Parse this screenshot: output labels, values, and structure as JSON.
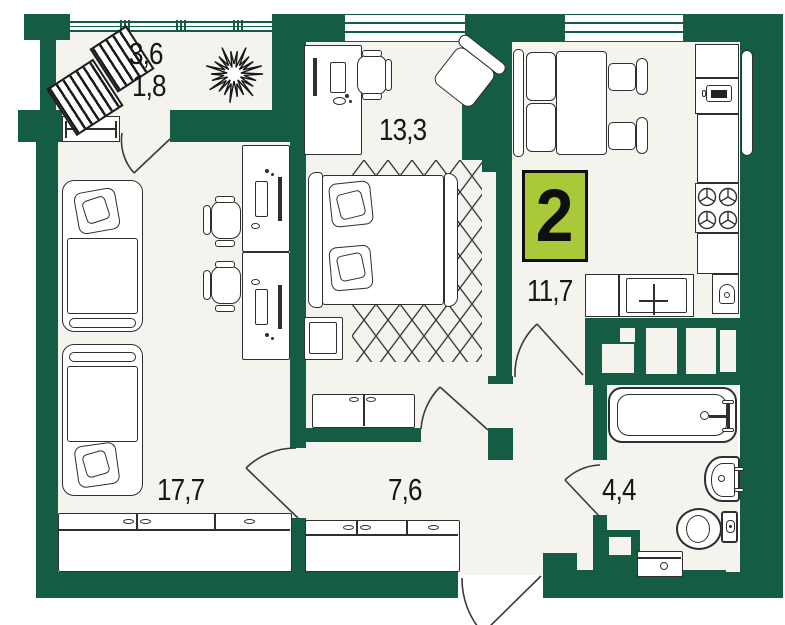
{
  "badge": {
    "value": "2"
  },
  "labels": {
    "balcony_area": "3,6",
    "balcony_area_reduced": "1,8",
    "bedroom_area": "13,3",
    "kitchen_hall_area": "11,7",
    "living_room_area": "17,7",
    "corridor_area": "7,6",
    "bathroom_area": "4,4"
  },
  "colors": {
    "wall": "#155c44",
    "floor": "#f5f3ee",
    "badge_fill": "#a9c938",
    "outline": "#2f2f2f"
  },
  "symbols": [
    "lounger-icon",
    "plant-icon",
    "single-bed-icon",
    "desk-icon",
    "office-chair-icon",
    "double-bed-icon",
    "rug-icon",
    "nightstand-icon",
    "wardrobe-icon",
    "shoe-cabinet-icon",
    "dining-bench-icon",
    "dining-table-icon",
    "chair-icon",
    "fridge-icon",
    "microwave-icon",
    "stove-icon",
    "kitchen-sink-icon",
    "kettle-icon",
    "radiator-icon",
    "bathtub-icon",
    "wash-basin-icon",
    "toilet-icon",
    "washing-machine-icon",
    "door-arc",
    "window",
    "vent-shaft"
  ]
}
